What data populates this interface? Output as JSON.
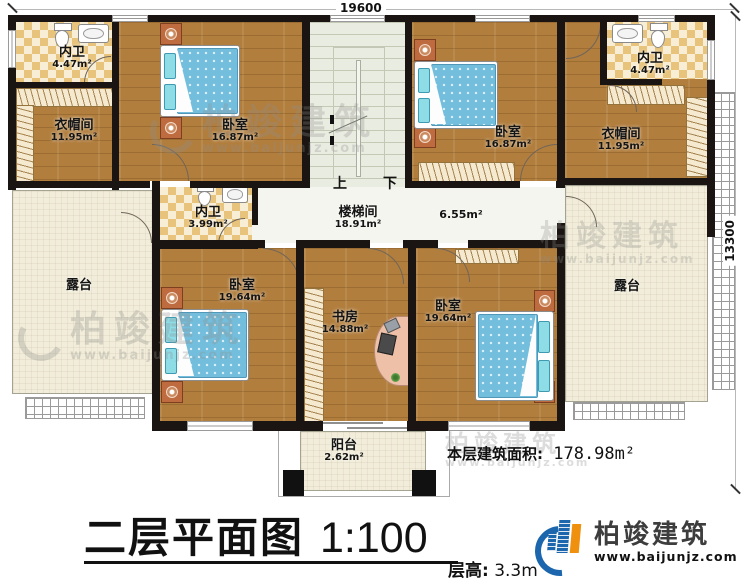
{
  "dims": {
    "top": "19600",
    "right": "13300"
  },
  "stairs": {
    "up": "上",
    "down": "下"
  },
  "rooms": [
    {
      "id": "bath-top-left",
      "name": "内卫",
      "area": "4.47m²"
    },
    {
      "id": "closet-top-left",
      "name": "衣帽间",
      "area": "11.95m²"
    },
    {
      "id": "bedroom-top-left",
      "name": "卧室",
      "area": "16.87m²"
    },
    {
      "id": "stair-hall",
      "name": "楼梯间",
      "area": "18.91m²"
    },
    {
      "id": "hallway",
      "name": "",
      "area": "6.55m²"
    },
    {
      "id": "bedroom-top-right",
      "name": "卧室",
      "area": "16.87m²"
    },
    {
      "id": "closet-top-right",
      "name": "衣帽间",
      "area": "11.95m²"
    },
    {
      "id": "bath-top-right",
      "name": "内卫",
      "area": "4.47m²"
    },
    {
      "id": "bath-middle",
      "name": "内卫",
      "area": "3.99m²"
    },
    {
      "id": "terrace-left",
      "name": "露台",
      "area": ""
    },
    {
      "id": "terrace-right",
      "name": "露台",
      "area": ""
    },
    {
      "id": "bedroom-bottom-left",
      "name": "卧室",
      "area": "19.64m²"
    },
    {
      "id": "study",
      "name": "书房",
      "area": "14.88m²"
    },
    {
      "id": "bedroom-bottom-right",
      "name": "卧室",
      "area": "19.64m²"
    },
    {
      "id": "balcony",
      "name": "阳台",
      "area": "2.62m²"
    }
  ],
  "footer": {
    "area_label": "本层建筑面积:",
    "area_value": " 178.98m²",
    "title": "二层平面图",
    "scale": "1:100",
    "height_label": "层高:",
    "height_value": " 3.3m"
  },
  "brand": {
    "name": "柏竣建筑",
    "url": "www.baijunjz.com"
  },
  "watermark": {
    "name": "柏竣建筑",
    "url": "www.baijunjz.com"
  },
  "colors": {
    "wall": "#1a1512",
    "wood_floor": "#b17e3e",
    "bath_tile": "#e7c37b",
    "terrace": "#f2edda",
    "bed_blue": "#74bedd",
    "stand_orange": "#bf6b40",
    "brand_blue": "#1b66ad",
    "brand_orange": "#f0900f"
  }
}
